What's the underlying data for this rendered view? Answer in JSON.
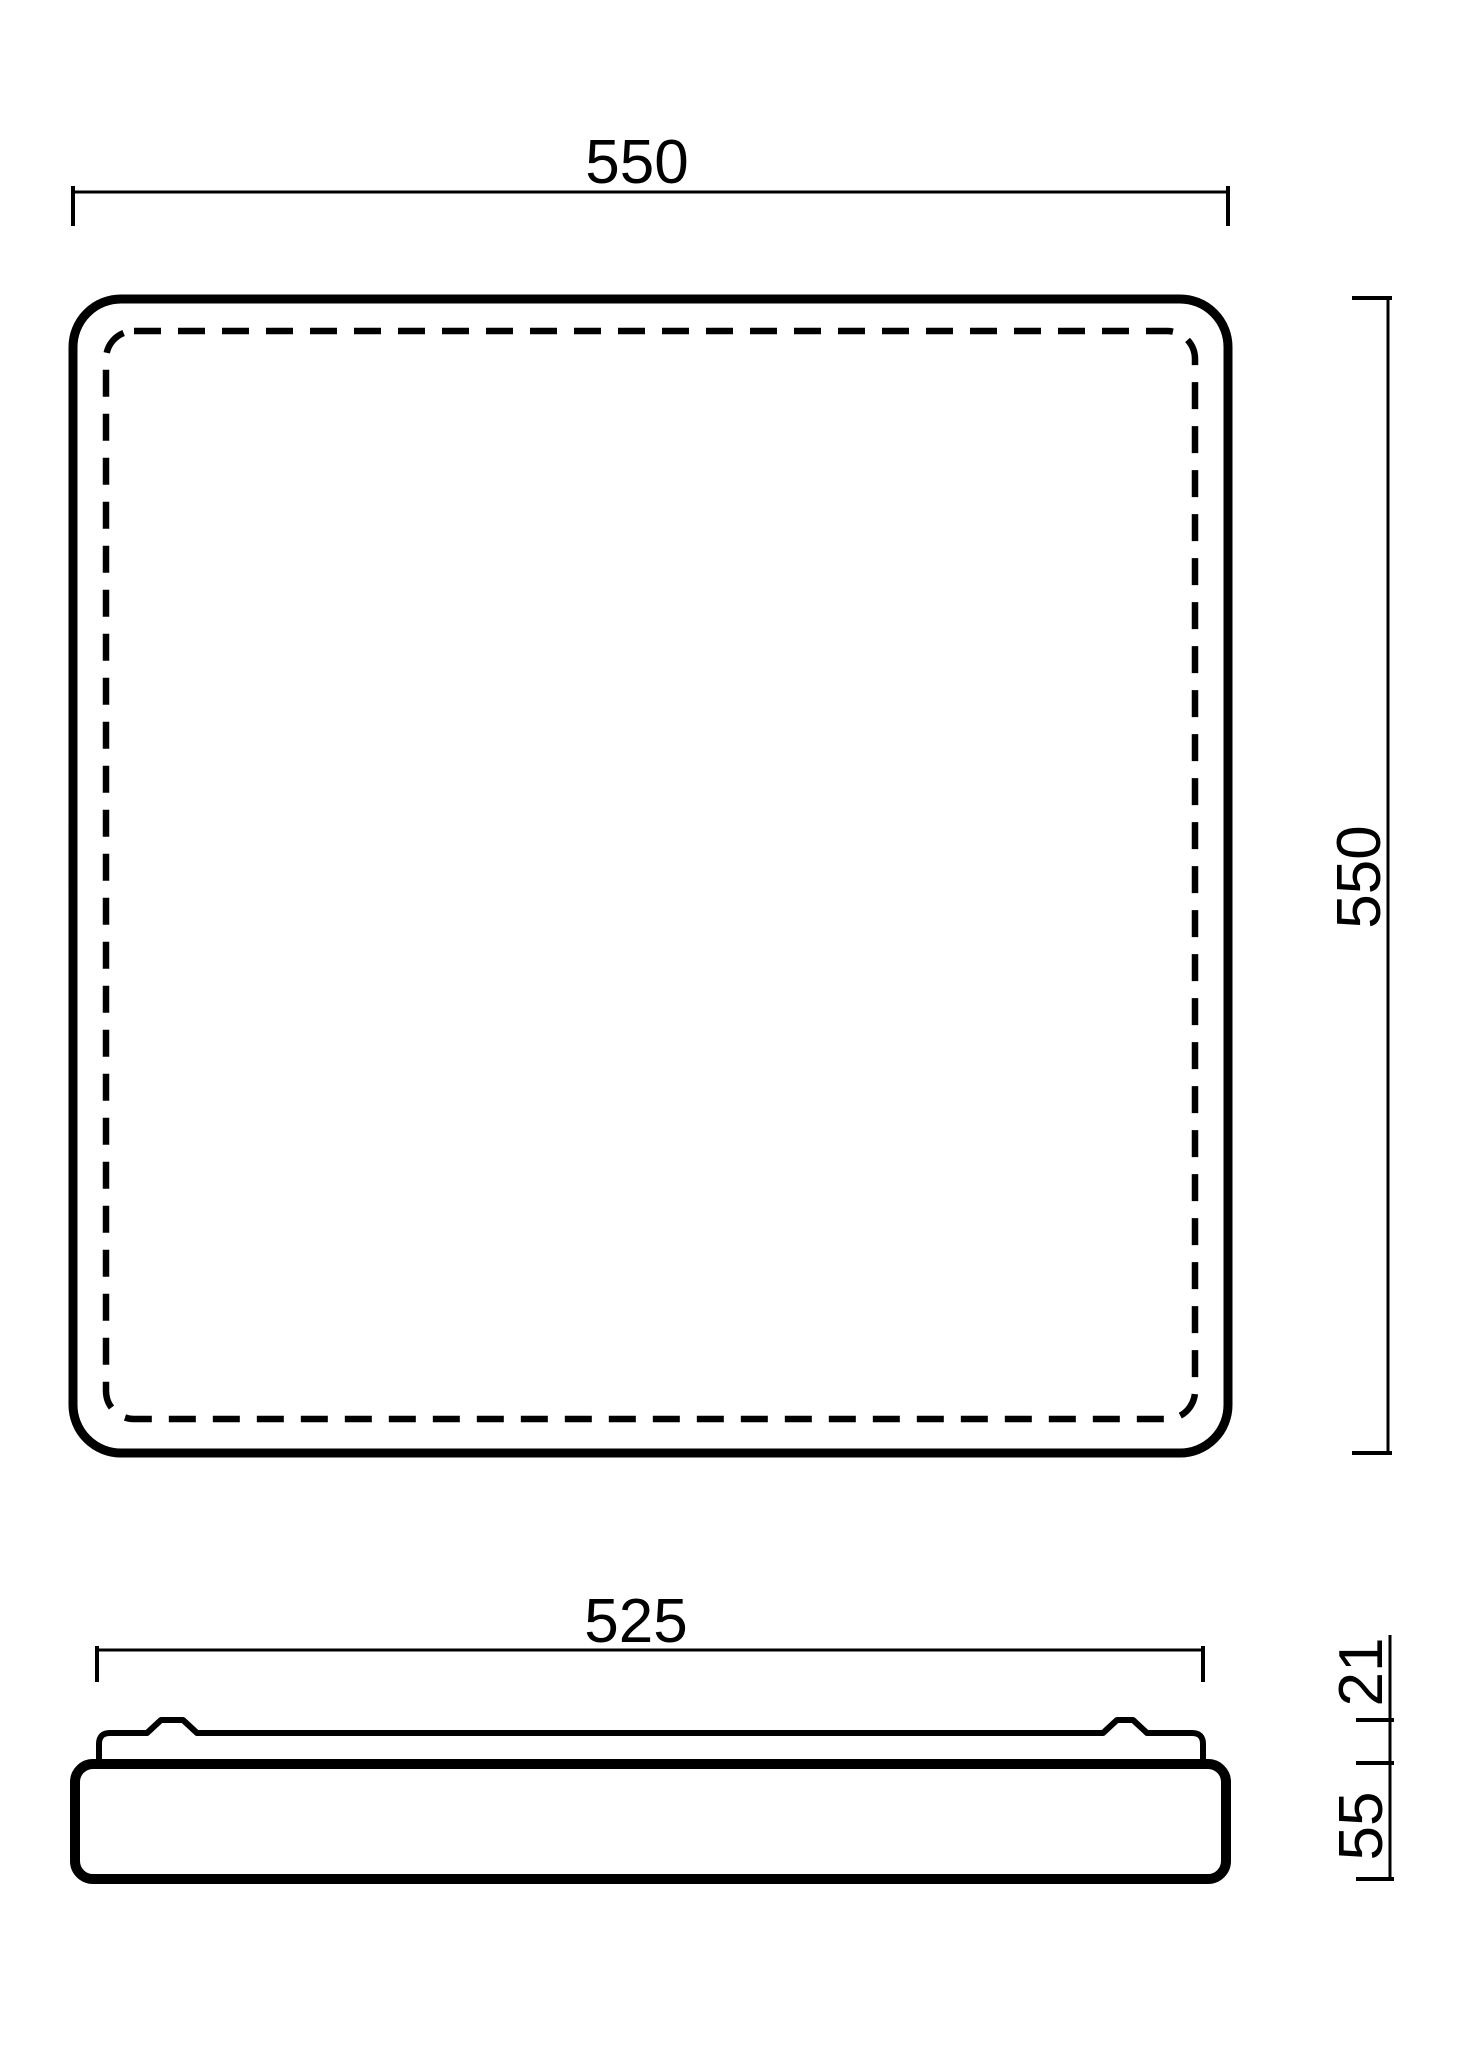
{
  "drawing": {
    "kind": "technical dimension drawing, square ceiling luminaire, two orthographic views",
    "colors": {
      "line": "#000000",
      "background": "#ffffff"
    },
    "top_view": {
      "width_dim": "550",
      "height_dim": "550"
    },
    "side_view": {
      "width_dim": "525",
      "upper_height_dim": "21",
      "body_height_dim": "55"
    }
  }
}
